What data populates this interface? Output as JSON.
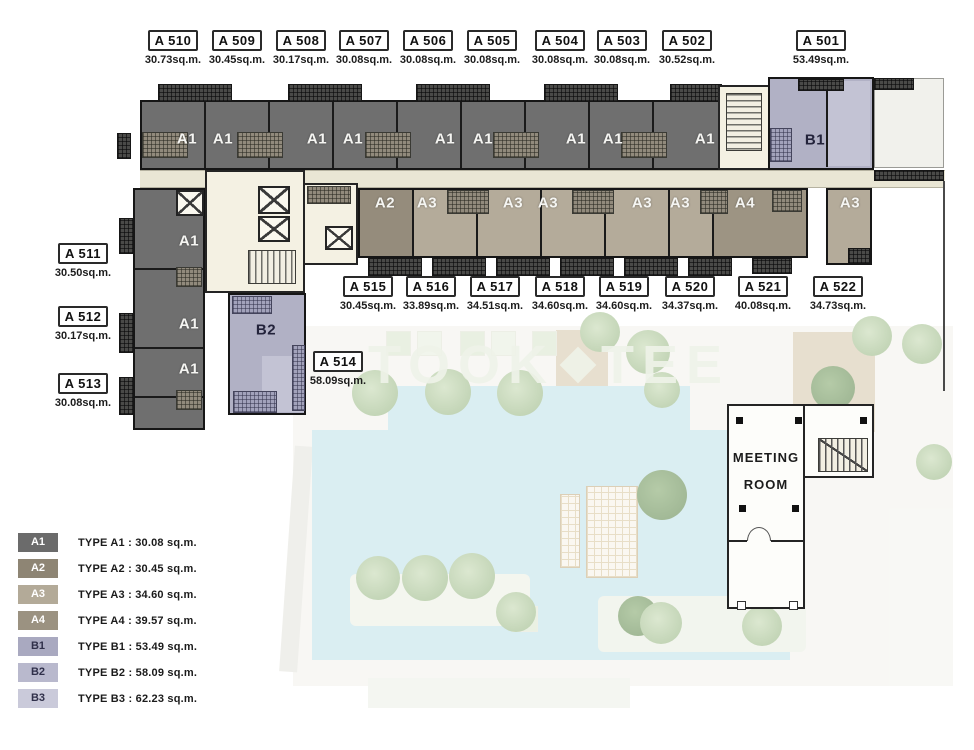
{
  "units": {
    "top": [
      {
        "id": "A 510",
        "area": "30.73sq.m.",
        "x": 138
      },
      {
        "id": "A 509",
        "area": "30.45sq.m.",
        "x": 202
      },
      {
        "id": "A 508",
        "area": "30.17sq.m.",
        "x": 266
      },
      {
        "id": "A 507",
        "area": "30.08sq.m.",
        "x": 329
      },
      {
        "id": "A 506",
        "area": "30.08sq.m.",
        "x": 393
      },
      {
        "id": "A 505",
        "area": "30.08sq.m.",
        "x": 457
      },
      {
        "id": "A 504",
        "area": "30.08sq.m.",
        "x": 525
      },
      {
        "id": "A 503",
        "area": "30.08sq.m.",
        "x": 587
      },
      {
        "id": "A 502",
        "area": "30.52sq.m.",
        "x": 652
      },
      {
        "id": "A 501",
        "area": "53.49sq.m.",
        "x": 786
      }
    ],
    "left": [
      {
        "id": "A 511",
        "area": "30.50sq.m.",
        "x": 48,
        "y": 243
      },
      {
        "id": "A 512",
        "area": "30.17sq.m.",
        "x": 48,
        "y": 306
      },
      {
        "id": "A 513",
        "area": "30.08sq.m.",
        "x": 48,
        "y": 373
      }
    ],
    "mid": [
      {
        "id": "A 515",
        "area": "30.45sq.m.",
        "x": 333
      },
      {
        "id": "A 516",
        "area": "33.89sq.m.",
        "x": 396
      },
      {
        "id": "A 517",
        "area": "34.51sq.m.",
        "x": 460
      },
      {
        "id": "A 518",
        "area": "34.60sq.m.",
        "x": 525
      },
      {
        "id": "A 519",
        "area": "34.60sq.m.",
        "x": 589
      },
      {
        "id": "A 520",
        "area": "34.37sq.m.",
        "x": 655
      },
      {
        "id": "A 521",
        "area": "40.08sq.m.",
        "x": 728
      },
      {
        "id": "A 522",
        "area": "34.73sq.m.",
        "x": 803
      }
    ],
    "a514": {
      "id": "A 514",
      "area": "58.09sq.m."
    }
  },
  "type_marks": [
    {
      "t": "A1",
      "x": 187,
      "y": 139
    },
    {
      "t": "A1",
      "x": 223,
      "y": 139
    },
    {
      "t": "A1",
      "x": 317,
      "y": 139
    },
    {
      "t": "A1",
      "x": 353,
      "y": 139
    },
    {
      "t": "A1",
      "x": 445,
      "y": 139
    },
    {
      "t": "A1",
      "x": 483,
      "y": 139
    },
    {
      "t": "A1",
      "x": 576,
      "y": 139
    },
    {
      "t": "A1",
      "x": 613,
      "y": 139
    },
    {
      "t": "A1",
      "x": 705,
      "y": 139
    },
    {
      "t": "B1",
      "x": 815,
      "y": 140,
      "cls": "dk"
    },
    {
      "t": "A2",
      "x": 385,
      "y": 203
    },
    {
      "t": "A3",
      "x": 427,
      "y": 203
    },
    {
      "t": "A3",
      "x": 513,
      "y": 203
    },
    {
      "t": "A3",
      "x": 548,
      "y": 203
    },
    {
      "t": "A3",
      "x": 642,
      "y": 203
    },
    {
      "t": "A3",
      "x": 680,
      "y": 203
    },
    {
      "t": "A4",
      "x": 745,
      "y": 203
    },
    {
      "t": "A3",
      "x": 850,
      "y": 203
    },
    {
      "t": "A1",
      "x": 189,
      "y": 241
    },
    {
      "t": "A1",
      "x": 189,
      "y": 324
    },
    {
      "t": "A1",
      "x": 189,
      "y": 369
    },
    {
      "t": "B2",
      "x": 266,
      "y": 330,
      "cls": "dk"
    }
  ],
  "meeting_room": {
    "line1": "MEETING",
    "line2": "ROOM"
  },
  "watermark": {
    "left": "TOOK",
    "right": "TEE"
  },
  "legend": [
    {
      "code": "A1",
      "label": "TYPE A1 : 30.08 sq.m.",
      "color": "#6b6b6b",
      "text": "#ffffff"
    },
    {
      "code": "A2",
      "label": "TYPE A2 : 30.45 sq.m.",
      "color": "#8e8574",
      "text": "#ffffff"
    },
    {
      "code": "A3",
      "label": "TYPE A3 : 34.60 sq.m.",
      "color": "#b3aa98",
      "text": "#ffffff"
    },
    {
      "code": "A4",
      "label": "TYPE A4 : 39.57 sq.m.",
      "color": "#9b9281",
      "text": "#ffffff"
    },
    {
      "code": "B1",
      "label": "TYPE B1 : 53.49 sq.m.",
      "color": "#a9a9c0",
      "text": "#30304a"
    },
    {
      "code": "B2",
      "label": "TYPE B2 : 58.09 sq.m.",
      "color": "#b9b9cd",
      "text": "#30304a"
    },
    {
      "code": "B3",
      "label": "TYPE B3 : 62.23 sq.m.",
      "color": "#cacada",
      "text": "#30304a"
    }
  ]
}
